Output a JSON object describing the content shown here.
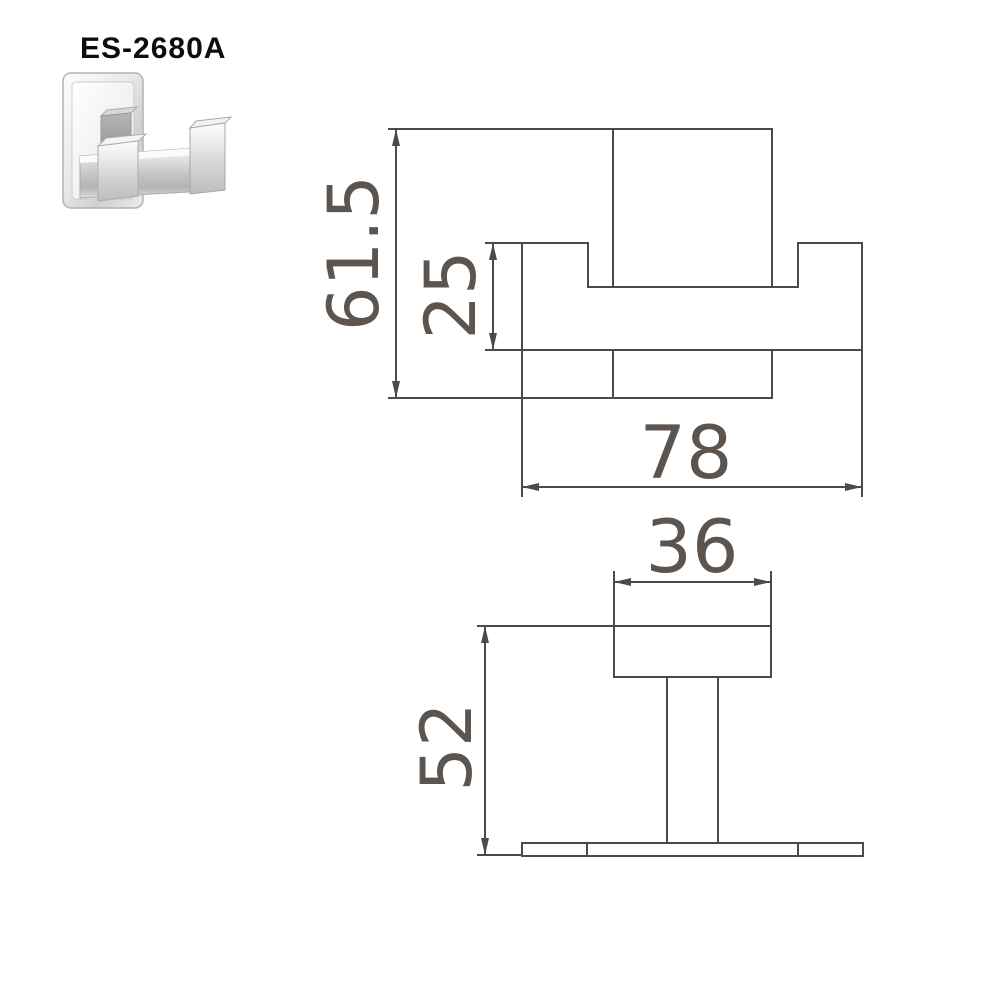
{
  "page": {
    "background": "#ffffff"
  },
  "product": {
    "code": "ES-2680A"
  },
  "photo": {
    "description": "chrome double robe hook"
  },
  "front_view": {
    "dim_total_height": "61.5",
    "dim_arm_height": "25",
    "dim_total_width": "78"
  },
  "side_view": {
    "dim_tip_width": "36",
    "dim_projection": "52"
  },
  "colors": {
    "drawing_line": "#4f4a47",
    "dim_text": "#5b544f",
    "code_text": "#0d0d0d"
  }
}
